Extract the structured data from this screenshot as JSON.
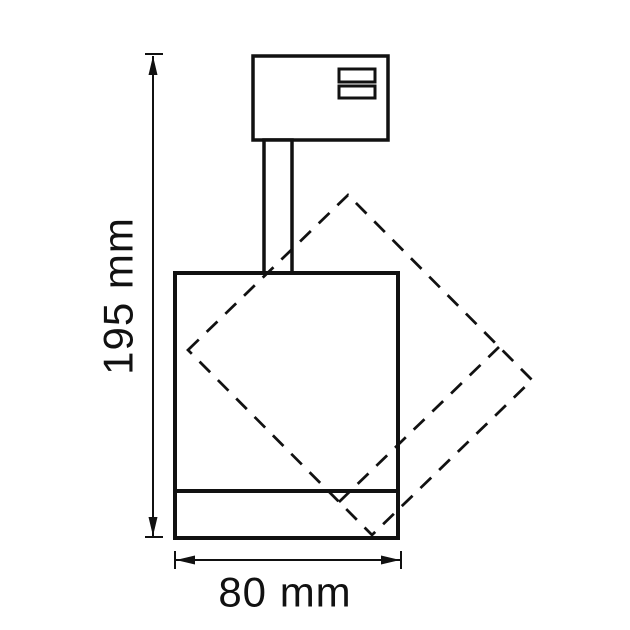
{
  "diagram": {
    "kind": "technical-dimension-drawing",
    "dimensions": {
      "height": {
        "label": "195 mm",
        "value": 195,
        "unit": "mm"
      },
      "width": {
        "label": "80 mm",
        "value": 80,
        "unit": "mm"
      }
    },
    "colors": {
      "line": "#111111",
      "background": "#ffffff"
    }
  }
}
